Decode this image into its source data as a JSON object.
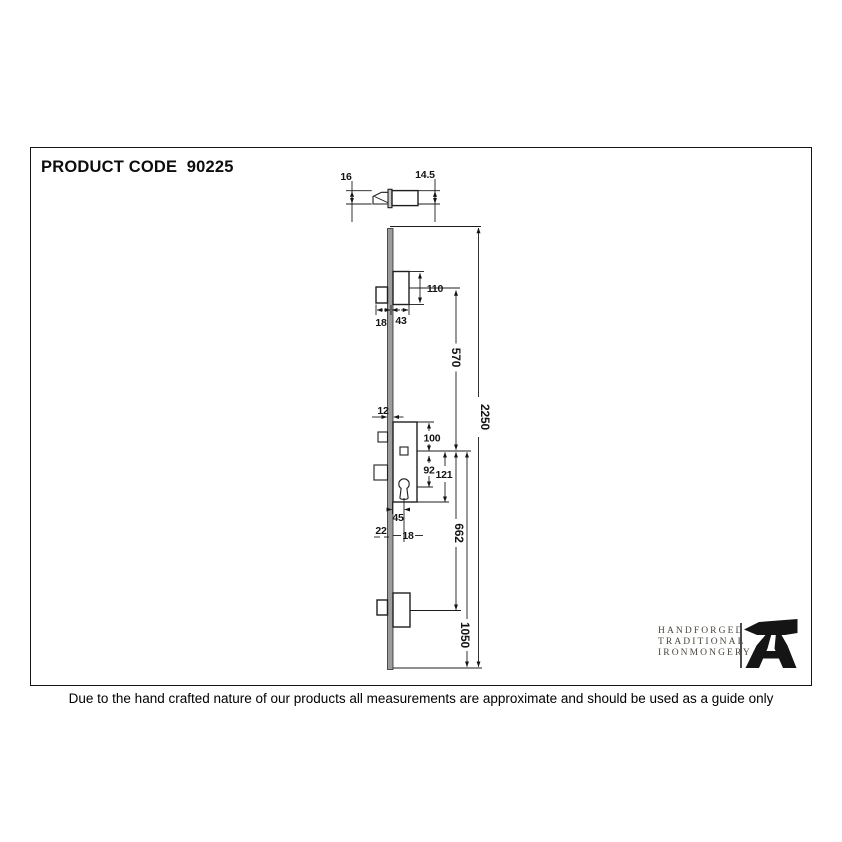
{
  "page": {
    "title": "PRODUCT CODE  90225",
    "footer": "Due to the hand crafted nature of our products all measurements are approximate and should be used as a guide only"
  },
  "logo": {
    "lines": [
      "HANDFORGED",
      "TRADITIONAL",
      "IRONMONGERY"
    ],
    "icon": "anvil-icon",
    "text_color": "#4a463e",
    "icon_color": "#151515"
  },
  "drawing": {
    "type": "technical-diagram",
    "subject": "multipoint-door-lock",
    "colors": {
      "line": "#1c1c1c",
      "faceplate_fill": "#9c9c9c",
      "background": "#ffffff"
    },
    "dims": {
      "plate_width_plan": "16",
      "bolt_width_plan": "14.5",
      "hook_height": "110",
      "hook_throw": "18",
      "hook_case_depth": "43",
      "top_hook_spacing": "570",
      "overall_length": "2250",
      "faceplate_width": "12",
      "case_top_to_spindle": "100",
      "spindle_to_cylinder": "92",
      "case_height": "121",
      "backset": "45",
      "plate_edge": "22",
      "centre_to_edge": "18",
      "bottom_hook_spacing": "662",
      "bottom_section": "1050"
    }
  }
}
